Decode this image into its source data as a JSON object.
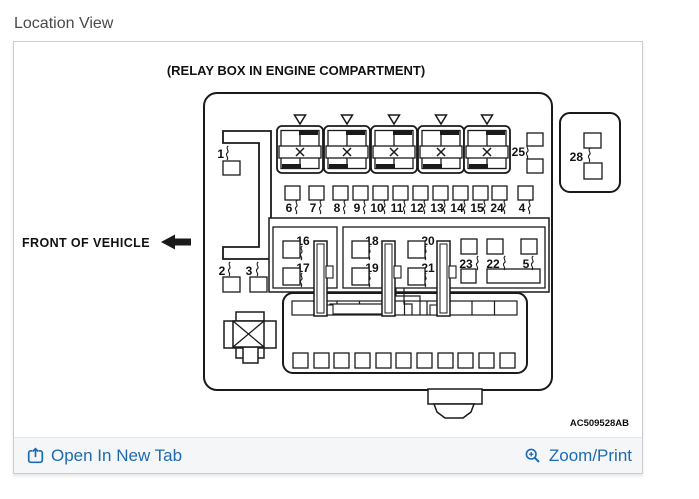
{
  "page": {
    "heading": "Location View"
  },
  "diagram": {
    "caption": "(RELAY BOX IN ENGINE COMPARTMENT)",
    "front_of_vehicle": "FRONT OF VEHICLE",
    "part_code": "AC509528AB",
    "relay_labels": {
      "left": "1",
      "right": "25",
      "side_box": "28"
    },
    "fuse_labels": [
      "6",
      "7",
      "8",
      "9",
      "10",
      "11",
      "12",
      "13",
      "14",
      "15",
      "24",
      "4"
    ],
    "mid_labels": [
      "16",
      "17",
      "18",
      "19",
      "20",
      "21"
    ],
    "right_labels": [
      "23",
      "22",
      "5"
    ],
    "bottom_left_labels": [
      "2",
      "3"
    ]
  },
  "footer": {
    "open_in_new_tab": "Open In New Tab",
    "zoom_print": "Zoom/Print"
  },
  "colors": {
    "link_blue": "#1e6ab2",
    "footer_bg": "#f4f6f8",
    "panel_border": "#c9cdd2",
    "diagram_ink": "#1a1a1a",
    "heading_gray": "#4a4a4a"
  }
}
